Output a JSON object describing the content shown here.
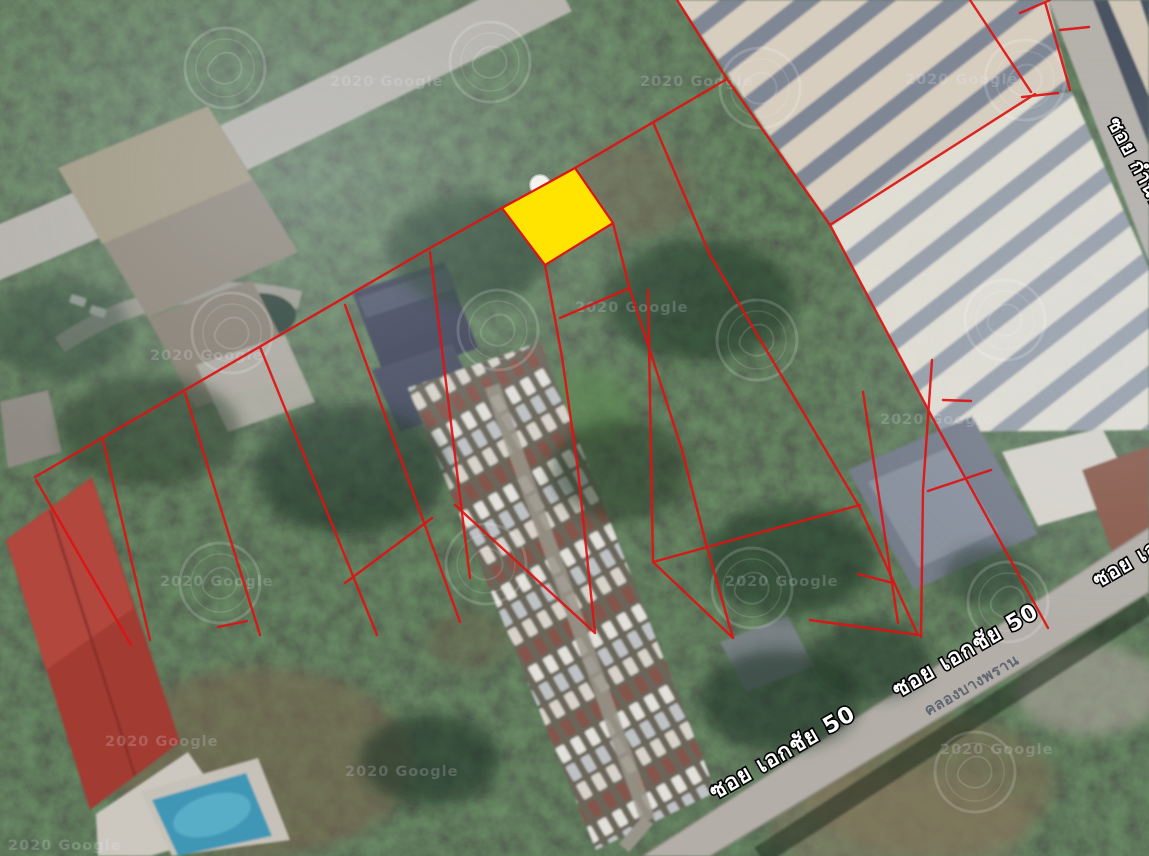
{
  "map": {
    "watermark": "2020 Google",
    "labels": {
      "road_main_1": "ซอย เอกชัย 50",
      "road_main_2": "ซอย เอกชัย 50",
      "road_right_edge": "ซอย เอกชัย",
      "road_top_right": "ซอย กำนัน",
      "canal": "คลองบางพราน"
    },
    "highlight": {
      "fill_color": "#ffe400",
      "border_color": "#e01212"
    },
    "overlay": {
      "parcel_line_color": "#e01212"
    }
  }
}
